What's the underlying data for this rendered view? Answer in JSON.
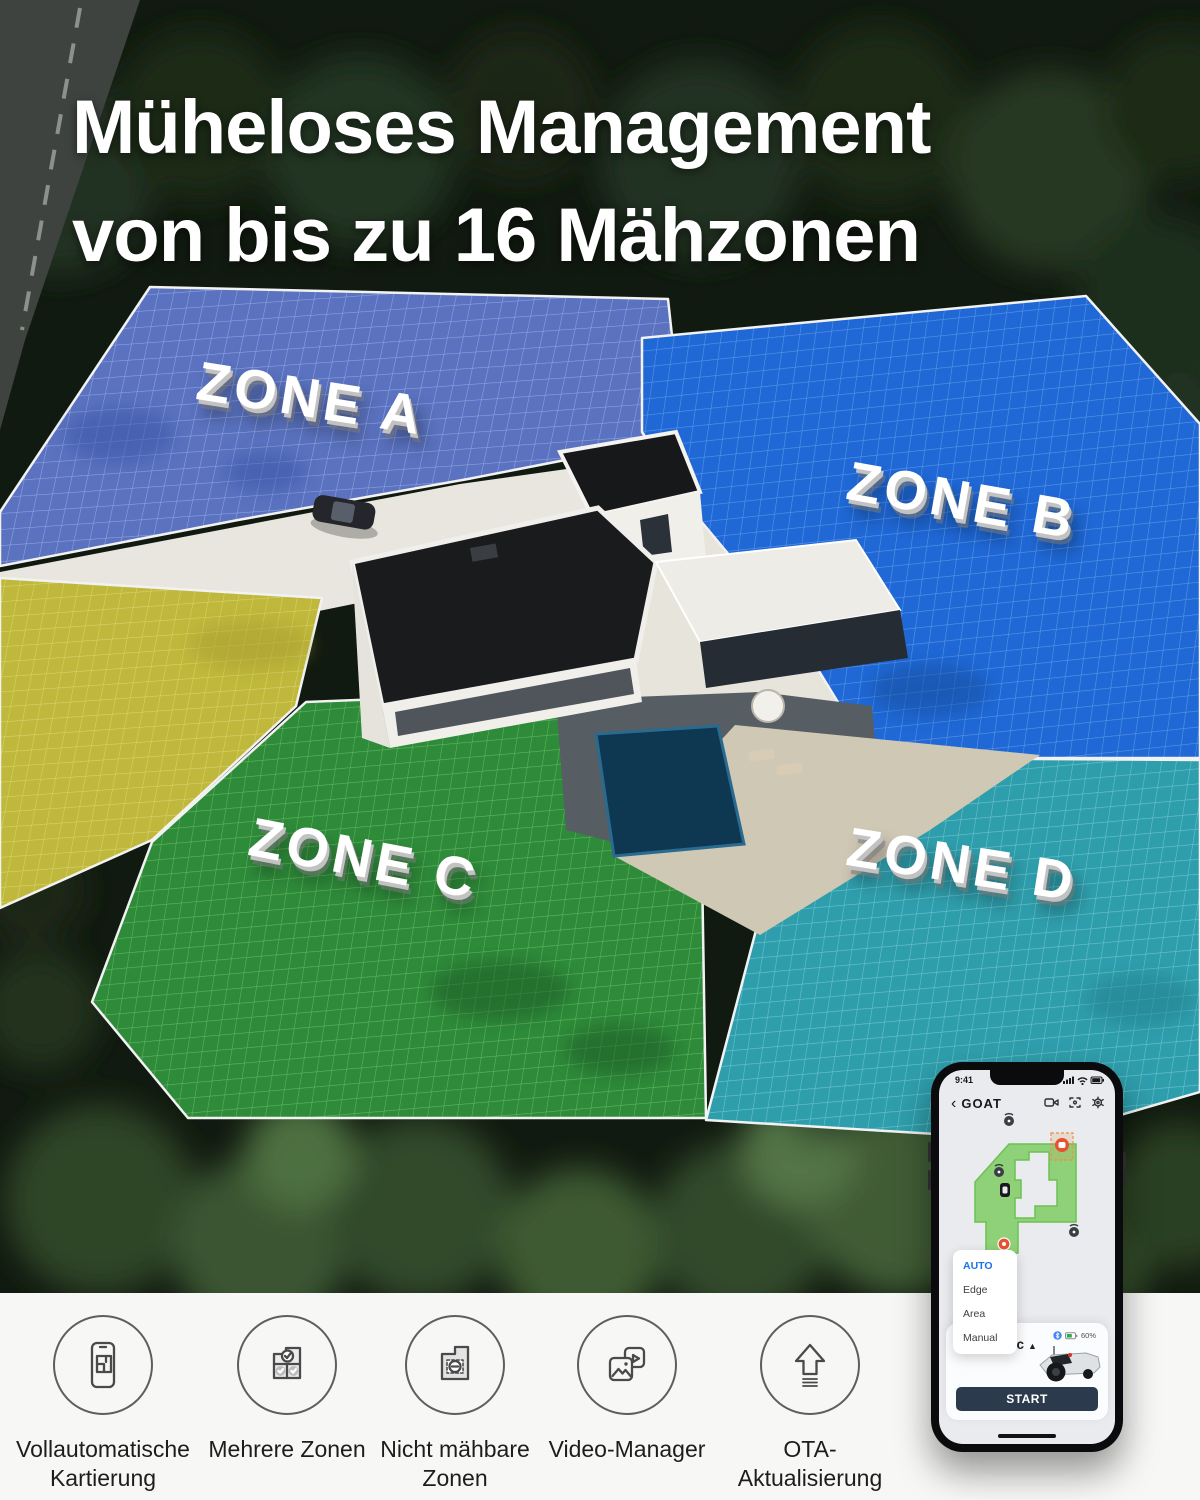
{
  "title": {
    "line1": "Müheloses Management",
    "line2": "von bis zu 16 Mähzonen"
  },
  "zones": [
    {
      "label": "ZONE A",
      "color": "#5a72bf"
    },
    {
      "label": "ZONE B",
      "color": "#1f68d6"
    },
    {
      "label": "ZONE C",
      "color": "#2e8b3a"
    },
    {
      "label": "ZONE D",
      "color": "#2f9eac"
    }
  ],
  "unassigned_zone_color": "#bfb83c",
  "phone": {
    "status": {
      "time": "9:41"
    },
    "header": {
      "back": "‹",
      "title": "GOAT",
      "icons": [
        "video-camera-icon",
        "map-icon",
        "gear-icon"
      ]
    },
    "map": {
      "markers": [
        "beacon-icon",
        "beacon-icon",
        "beacon-icon",
        "charging-station-icon",
        "robot-marker-icon",
        "gear-marker-icon"
      ]
    },
    "dropdown": {
      "options": [
        "AUTO",
        "Edge",
        "Area",
        "Manual"
      ],
      "selected": "AUTO",
      "selected_color": "#1a73e8"
    },
    "mode": {
      "label": "Automatic",
      "chevron": "▲"
    },
    "battery": {
      "percent": "60%"
    },
    "start_label": "START"
  },
  "features": [
    {
      "label": "Vollautomatische Kartierung",
      "icon": "phone-mapping-icon"
    },
    {
      "label": "Mehrere Zonen",
      "icon": "multi-zone-icon"
    },
    {
      "label": "Nicht mähbare Zonen",
      "icon": "no-mow-zone-icon"
    },
    {
      "label": "Video-Manager",
      "icon": "video-manager-icon"
    },
    {
      "label": "OTA-Aktualisierung",
      "icon": "ota-update-icon"
    }
  ],
  "colors": {
    "accent_blue": "#1a73e8",
    "start_button": "#2b3b4d",
    "marker_orange": "#e85230",
    "map_lawn_green": "#8ed178",
    "strip_background": "#f7f7f5"
  }
}
